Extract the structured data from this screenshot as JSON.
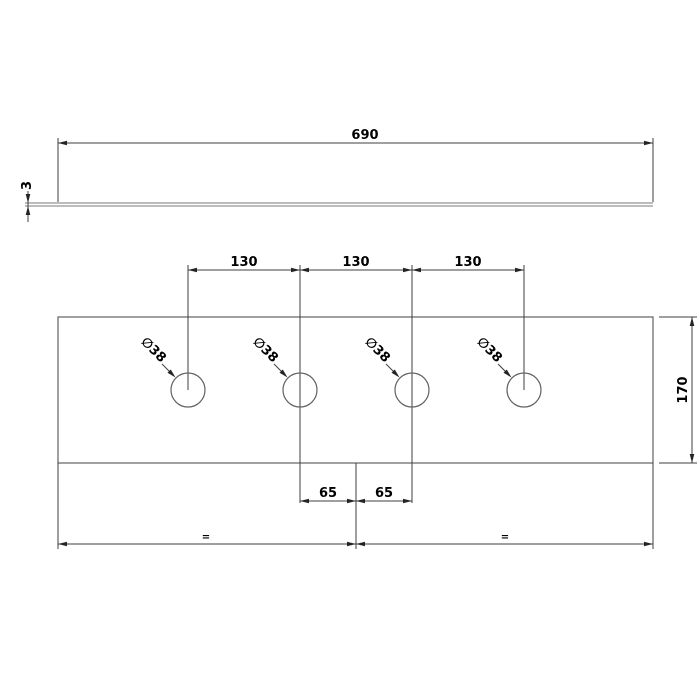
{
  "colors": {
    "background": "#ffffff",
    "geometry_line": "#606060",
    "dimension_line": "#3f3f3f",
    "text": "#000000"
  },
  "top_view": {
    "width_label": "690",
    "thickness_label": "3"
  },
  "front_view": {
    "spacing_labels": [
      "130",
      "130",
      "130"
    ],
    "hole_labels": [
      "∅38",
      "∅38",
      "∅38",
      "∅38"
    ],
    "height_label": "170",
    "offset_labels": [
      "65",
      "65"
    ],
    "equal_labels": [
      "=",
      "="
    ]
  }
}
